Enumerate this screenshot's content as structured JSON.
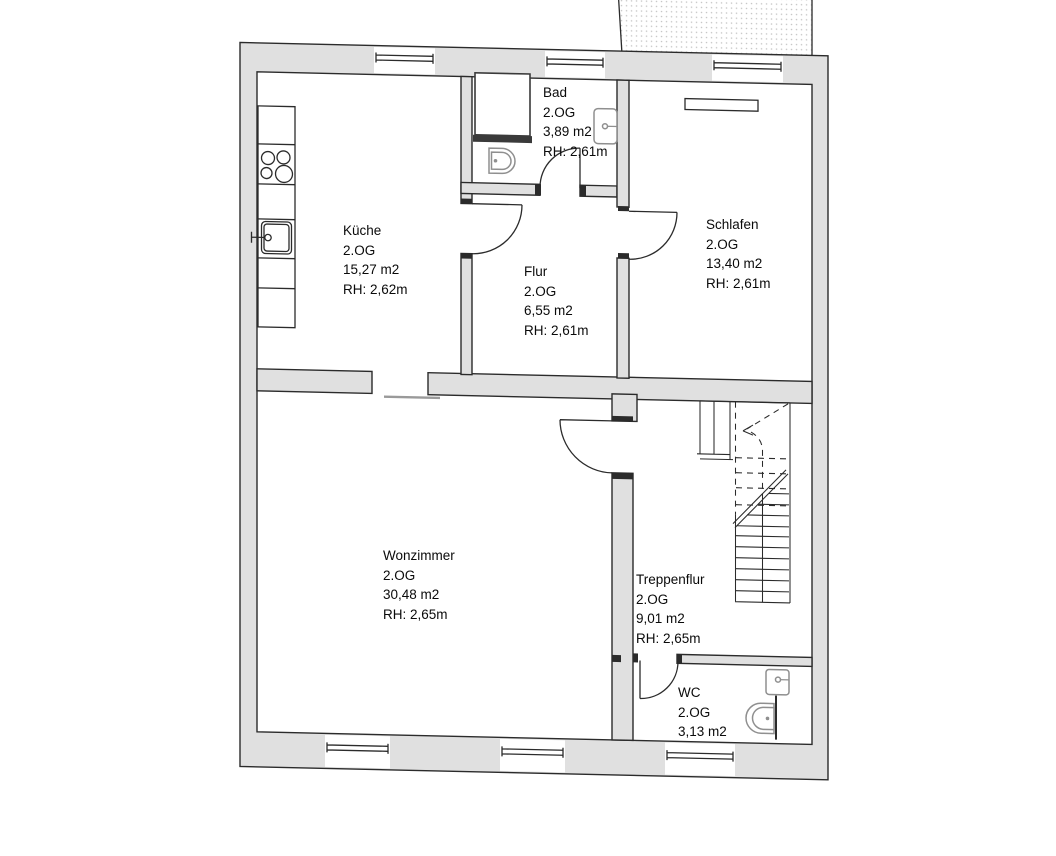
{
  "document": {
    "type": "floor-plan-scan",
    "floor_label": "2.OG"
  },
  "colors": {
    "line": "#2b2b2b",
    "wall-fill": "#e0e0e0",
    "wall-dark": "#3a3a3a",
    "fixture": "#8f8f8f",
    "thin": "#9a9a9a",
    "paper": "#ffffff",
    "ink": "#0a0a0a"
  },
  "rooms": [
    {
      "id": "kueche",
      "name": "Küche",
      "floor": "2.OG",
      "area": "15,27 m2",
      "rh": "RH: 2,62m"
    },
    {
      "id": "bad",
      "name": "Bad",
      "floor": "2.OG",
      "area": "3,89 m2",
      "rh": "RH: 2,61m"
    },
    {
      "id": "schlafen",
      "name": "Schlafen",
      "floor": "2.OG",
      "area": "13,40 m2",
      "rh": "RH: 2,61m"
    },
    {
      "id": "flur",
      "name": "Flur",
      "floor": "2.OG",
      "area": "6,55 m2",
      "rh": "RH: 2,61m"
    },
    {
      "id": "wohnzimmer",
      "name": "Wonzimmer",
      "floor": "2.OG",
      "area": "30,48 m2",
      "rh": "RH: 2,65m"
    },
    {
      "id": "treppenflur",
      "name": "Treppenflur",
      "floor": "2.OG",
      "area": "9,01 m2",
      "rh": "RH: 2,65m"
    },
    {
      "id": "wc",
      "name": "WC",
      "floor": "2.OG",
      "area": "3,13 m2"
    }
  ]
}
